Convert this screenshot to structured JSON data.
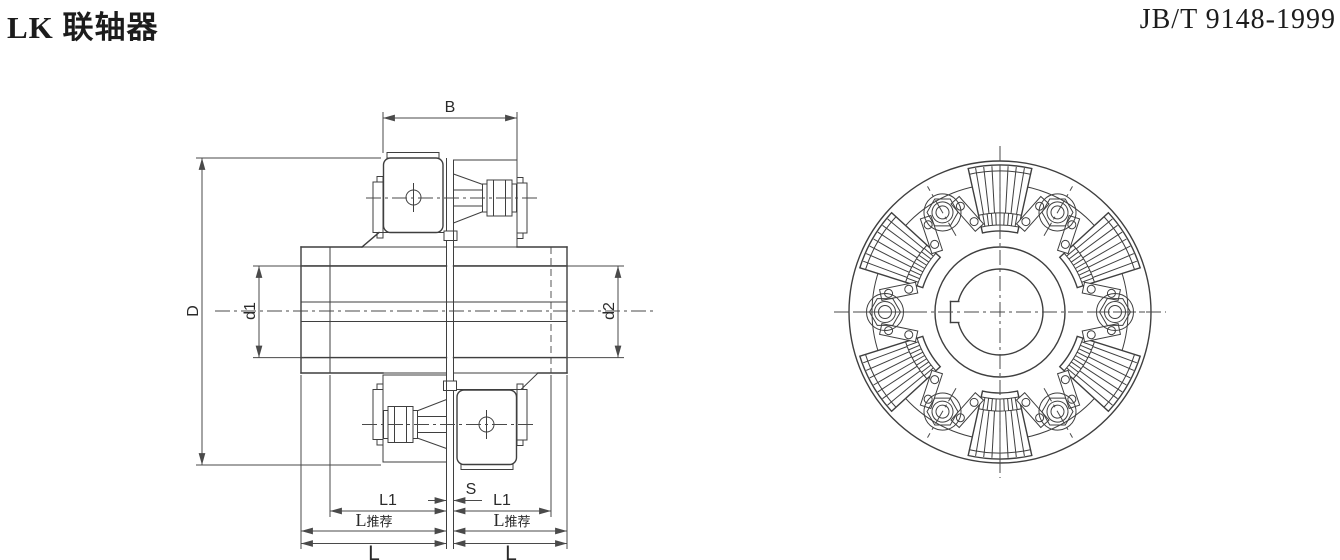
{
  "header": {
    "title": "LK 联轴器",
    "standard": "JB/T 9148-1999"
  },
  "colors": {
    "background": "#ffffff",
    "line": "#3f3f3f",
    "dimension_line": "#4a4a4a",
    "text": "#1c1c1c"
  },
  "section_view": {
    "labels": {
      "width_b": "B",
      "outer_diameter": "D",
      "bore_left": "d1",
      "bore_right": "d2",
      "hub_length": "L1",
      "gap": "S",
      "length_recommended_main": "L",
      "length_recommended_suffix": "推荐",
      "total_length": "L"
    }
  },
  "end_view": {
    "bolt_count": 6,
    "spring_segment_count": 6,
    "has_keyway": true
  }
}
